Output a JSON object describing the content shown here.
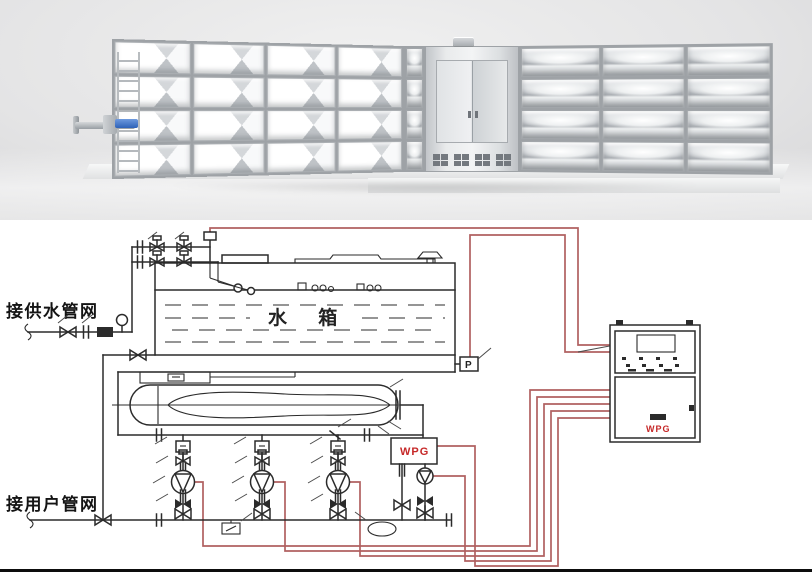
{
  "photo": {
    "description": "stainless steel modular panel water tank 3d render"
  },
  "diagram": {
    "labels": {
      "supply_network": "接供水管网",
      "user_network": "接用户管网",
      "tank": "水  箱",
      "pressure_sensor": "P",
      "wpg_unit": "WPG",
      "cabinet_brand": "WPG"
    },
    "colors": {
      "line": "#2b2b2b",
      "wire": "#b06060",
      "accent_red": "#c62828",
      "blue": "#3a74c9"
    }
  }
}
